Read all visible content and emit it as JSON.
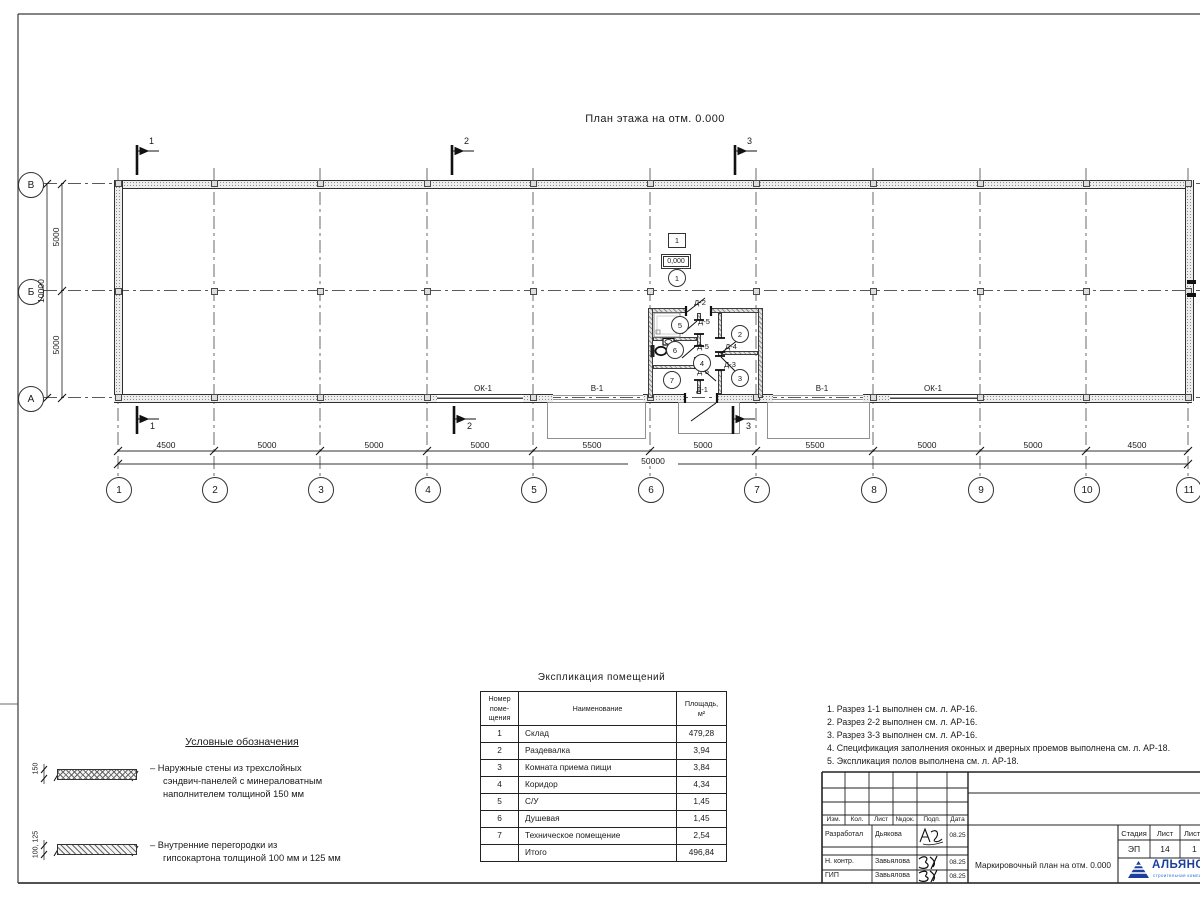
{
  "drawing": {
    "plan_title": "План этажа на отм. 0.000",
    "axes_h": [
      "1",
      "2",
      "3",
      "4",
      "5",
      "6",
      "7",
      "8",
      "9",
      "10",
      "11"
    ],
    "axes_v": [
      "В",
      "Б",
      "А"
    ],
    "dims": [
      "4500",
      "5000",
      "5000",
      "5000",
      "5500",
      "5000",
      "5500",
      "5000",
      "5000",
      "4500"
    ],
    "dim_total": "50000",
    "dims_left": [
      "5000",
      "5000"
    ],
    "dim_left_total": "10000",
    "sections": [
      "1",
      "2",
      "3"
    ],
    "elevation_mark": "0,000",
    "floor_type_mark": "1",
    "rooms": [
      "1",
      "2",
      "3",
      "4",
      "5",
      "6",
      "7"
    ],
    "openings": {
      "ok1_left": "ОК-1",
      "v1_left": "В-1",
      "d1": "Д-1",
      "v1_right": "В-1",
      "ok1_right": "ОК-1",
      "d2": "Д-2",
      "d3": "Д-3",
      "d4": "Д-4",
      "d5a": "Д-5",
      "d5b": "Д-5",
      "d5c": "Д-5"
    }
  },
  "legend": {
    "title": "Условные обозначения",
    "item1_dim": "150",
    "item1_text": "– Наружные стены из трехслойных\nсэндвич-панелей с минераловатным\nнаполнителем толщиной 150 мм",
    "item2_dim": "100, 125",
    "item2_text": "– Внутренние перегородки из\nгипсокартона толщиной 100 мм и 125 мм"
  },
  "schedule": {
    "title": "Экспликация помещений",
    "col1": "Номер\nпоме-\nщения",
    "col2": "Наименование",
    "col3": "Площадь,\nм²",
    "rows": [
      {
        "num": "1",
        "name": "Склад",
        "area": "479,28"
      },
      {
        "num": "2",
        "name": "Раздевалка",
        "area": "3,94"
      },
      {
        "num": "3",
        "name": "Комната приема пищи",
        "area": "3,84"
      },
      {
        "num": "4",
        "name": "Коридор",
        "area": "4,34"
      },
      {
        "num": "5",
        "name": "С/У",
        "area": "1,45"
      },
      {
        "num": "6",
        "name": "Душевая",
        "area": "1,45"
      },
      {
        "num": "7",
        "name": "Техническое помещение",
        "area": "2,54"
      },
      {
        "num": "",
        "name": "Итого",
        "area": "496,84"
      }
    ]
  },
  "notes": [
    "1. Разрез 1-1 выполнен см. л. АР-16.",
    "2. Разрез 2-2 выполнен см. л. АР-16.",
    "3. Разрез 3-3 выполнен см. л. АР-16.",
    "4. Спецификация заполнения оконных и дверных проемов выполнена см. л. АР-18.",
    "5. Экспликация полов выполнена см. л. АР-18."
  ],
  "titleblock": {
    "header_cols": [
      "Изм.",
      "Кол.",
      "Лист",
      "№док.",
      "Подп.",
      "Дата"
    ],
    "rows": [
      {
        "role": "Разработал",
        "name": "Дьякова",
        "date": "08.25"
      },
      {
        "role": "Н. контр.",
        "name": "Завьялова",
        "date": "08.25"
      },
      {
        "role": "ГИП",
        "name": "Завьялова",
        "date": "08.25"
      }
    ],
    "doc_title": "Маркировочный план на отм. 0.000",
    "stage_label": "Стадия",
    "sheet_label": "Лист",
    "sheets_label": "Листов",
    "stage": "ЭП",
    "sheet": "14",
    "sheets": "1",
    "logo_text": "АЛЬЯНС",
    "logo_sub": "строительная компания",
    "logo_color": "#1c3f9e"
  }
}
